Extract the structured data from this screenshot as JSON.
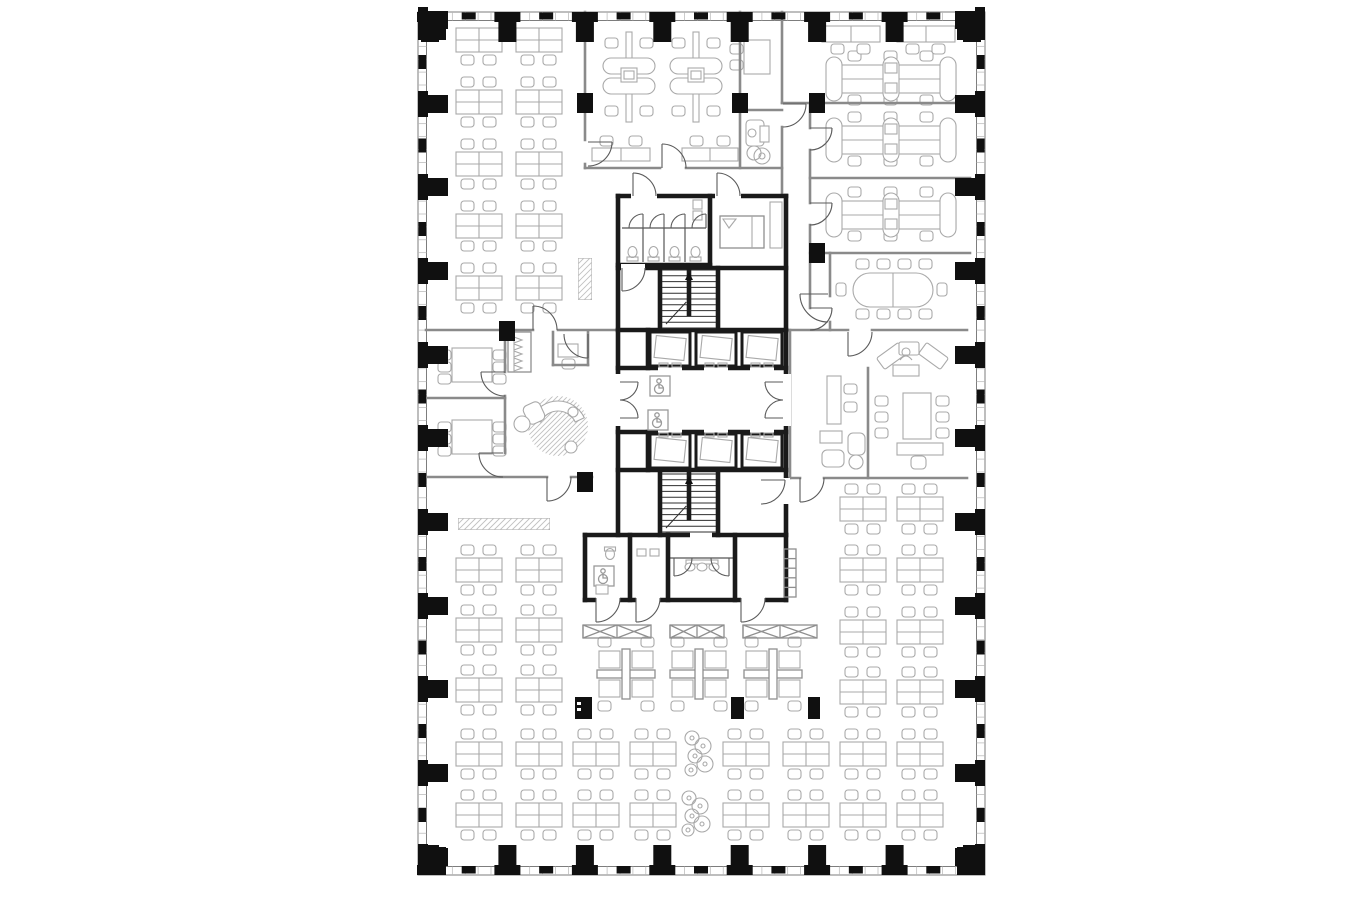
{
  "palette": {
    "background": "#ffffff",
    "wall_heavy": "#1a1a1a",
    "wall_partition": "#8a8a8a",
    "furniture": "#a9a9a9",
    "column": "#101010",
    "door": "#5a5a5a",
    "hatch": "#c0c0c0"
  },
  "plan": {
    "x": 418,
    "y": 12,
    "w": 567,
    "h": 863,
    "inner_x": 426.5,
    "inner_y": 20.5,
    "inner_r": 976.5,
    "inner_b": 866.5,
    "mullion_step": 12.9
  },
  "perimeter_columns": {
    "top_x": [
      430,
      507.4,
      584.9,
      662.3,
      739.7,
      817.1,
      894.6,
      972
    ],
    "bottom_x": [
      430,
      507.4,
      584.9,
      662.3,
      739.7,
      817.1,
      894.6,
      972
    ],
    "left_y": [
      20,
      104,
      187,
      271,
      355,
      438,
      522,
      606,
      689,
      773,
      857
    ],
    "right_y": [
      20,
      104,
      187,
      271,
      355,
      438,
      522,
      606,
      689,
      773,
      857
    ]
  },
  "interior_columns": [
    [
      585,
      103
    ],
    [
      740,
      103
    ],
    [
      817,
      103
    ],
    [
      817,
      253
    ],
    [
      507,
      331
    ],
    [
      585,
      482
    ]
  ],
  "risers": [
    [
      575,
      697,
      17,
      22,
      1
    ],
    [
      731,
      697,
      13,
      22,
      0
    ],
    [
      808,
      697,
      12,
      22,
      0
    ]
  ],
  "partition_walls": [
    [
      585,
      12,
      585,
      140
    ],
    [
      585,
      164,
      585,
      168
    ],
    [
      585,
      168,
      660,
      168
    ],
    [
      686,
      168,
      782,
      168
    ],
    [
      740,
      12,
      740,
      168
    ],
    [
      740,
      110,
      782,
      110
    ],
    [
      782,
      12,
      782,
      103
    ],
    [
      782,
      127,
      782,
      196
    ],
    [
      782,
      103,
      970,
      103
    ],
    [
      810,
      103,
      810,
      128
    ],
    [
      810,
      150,
      810,
      203
    ],
    [
      810,
      225,
      810,
      308
    ],
    [
      810,
      178,
      970,
      178
    ],
    [
      810,
      253,
      970,
      253
    ],
    [
      830,
      253,
      830,
      296
    ],
    [
      830,
      322,
      830,
      330
    ],
    [
      786,
      330,
      848,
      330
    ],
    [
      872,
      330,
      967,
      330
    ],
    [
      790,
      330,
      790,
      478
    ],
    [
      868,
      368,
      868,
      478
    ],
    [
      786,
      478,
      800,
      478
    ],
    [
      824,
      478,
      967,
      478
    ],
    [
      426,
      330,
      533,
      330
    ],
    [
      558,
      330,
      618,
      330
    ],
    [
      505,
      332,
      505,
      372
    ],
    [
      505,
      396,
      505,
      453
    ],
    [
      426,
      398,
      505,
      398
    ],
    [
      426,
      477,
      547,
      477
    ],
    [
      571,
      477,
      592,
      477
    ],
    [
      553,
      332,
      553,
      365
    ],
    [
      553,
      365,
      588,
      365
    ],
    [
      588,
      332,
      588,
      365
    ]
  ],
  "heavy_walls": [
    [
      618,
      196,
      786,
      196
    ],
    [
      618,
      196,
      618,
      535
    ],
    [
      786,
      196,
      786,
      535
    ],
    [
      618,
      265,
      710,
      265
    ],
    [
      710,
      196,
      710,
      265
    ],
    [
      618,
      268,
      786,
      268
    ],
    [
      660,
      268,
      660,
      330
    ],
    [
      718,
      268,
      718,
      330
    ],
    [
      618,
      330,
      786,
      330
    ],
    [
      618,
      368,
      786,
      368
    ],
    [
      648,
      330,
      648,
      368
    ],
    [
      618,
      432,
      786,
      432
    ],
    [
      648,
      432,
      648,
      470
    ],
    [
      618,
      470,
      786,
      470
    ],
    [
      660,
      470,
      660,
      535
    ],
    [
      718,
      470,
      718,
      535
    ],
    [
      585,
      535,
      786,
      535
    ],
    [
      585,
      535,
      585,
      600
    ],
    [
      585,
      600,
      786,
      600
    ],
    [
      786,
      535,
      786,
      600
    ],
    [
      630,
      535,
      630,
      600
    ],
    [
      668,
      535,
      668,
      600
    ],
    [
      735,
      535,
      735,
      600
    ]
  ],
  "thin_walls": [
    [
      622,
      228,
      706,
      228
    ],
    [
      668,
      558,
      735,
      558
    ]
  ],
  "wall_gaps": [
    [
      613,
      374,
      10,
      52
    ],
    [
      780,
      374,
      11,
      52
    ],
    [
      658,
      364,
      24,
      8
    ],
    [
      704,
      364,
      24,
      8
    ],
    [
      750,
      364,
      24,
      8
    ],
    [
      658,
      428,
      24,
      8
    ],
    [
      704,
      428,
      24,
      8
    ],
    [
      750,
      428,
      24,
      8
    ],
    [
      631,
      192,
      26,
      8
    ],
    [
      715,
      192,
      26,
      8
    ],
    [
      596,
      596,
      24,
      8
    ],
    [
      636,
      596,
      24,
      8
    ],
    [
      741,
      596,
      24,
      8
    ],
    [
      782,
      478,
      8,
      26
    ],
    [
      621,
      264,
      24,
      8
    ],
    [
      690,
      531,
      22,
      8
    ]
  ],
  "doors": [
    {
      "h": [
        588,
        142
      ],
      "l": [
        588,
        166
      ],
      "e": [
        612,
        142
      ]
    },
    {
      "h": [
        662,
        168
      ],
      "l": [
        686,
        168
      ],
      "e": [
        662,
        144
      ]
    },
    {
      "h": [
        783,
        104
      ],
      "l": [
        783,
        127
      ],
      "e": [
        806,
        104
      ]
    },
    {
      "h": [
        810,
        128
      ],
      "l": [
        810,
        150
      ],
      "e": [
        832,
        128
      ]
    },
    {
      "h": [
        810,
        203
      ],
      "l": [
        810,
        225
      ],
      "e": [
        832,
        203
      ]
    },
    {
      "h": [
        810,
        308
      ],
      "l": [
        810,
        330
      ],
      "e": [
        832,
        308
      ]
    },
    {
      "h": [
        828,
        294
      ],
      "l": [
        828,
        322
      ],
      "e": [
        800,
        294
      ]
    },
    {
      "h": [
        848,
        332
      ],
      "l": [
        872,
        332
      ],
      "e": [
        848,
        356
      ]
    },
    {
      "h": [
        633,
        196
      ],
      "l": [
        656,
        196
      ],
      "e": [
        633,
        173
      ]
    },
    {
      "h": [
        717,
        196
      ],
      "l": [
        740,
        196
      ],
      "e": [
        717,
        173
      ]
    },
    {
      "h": [
        533,
        330
      ],
      "l": [
        557,
        330
      ],
      "e": [
        533,
        306
      ]
    },
    {
      "h": [
        505,
        372
      ],
      "l": [
        505,
        396
      ],
      "e": [
        481,
        372
      ]
    },
    {
      "h": [
        503,
        453
      ],
      "l": [
        503,
        477
      ],
      "e": [
        479,
        453
      ]
    },
    {
      "h": [
        547,
        477
      ],
      "l": [
        571,
        477
      ],
      "e": [
        547,
        501
      ]
    },
    {
      "h": [
        588,
        334
      ],
      "l": [
        564,
        334
      ],
      "e": [
        588,
        358
      ]
    },
    {
      "h": [
        622,
        268
      ],
      "l": [
        645,
        268
      ],
      "e": [
        622,
        291
      ]
    },
    {
      "h": [
        620,
        382
      ],
      "l": [
        620,
        400
      ],
      "e": [
        638,
        382
      ]
    },
    {
      "h": [
        620,
        418
      ],
      "l": [
        620,
        400
      ],
      "e": [
        638,
        418
      ]
    },
    {
      "h": [
        783,
        382
      ],
      "l": [
        783,
        400
      ],
      "e": [
        765,
        382
      ]
    },
    {
      "h": [
        783,
        418
      ],
      "l": [
        783,
        400
      ],
      "e": [
        765,
        418
      ]
    },
    {
      "h": [
        761,
        480
      ],
      "l": [
        761,
        504
      ],
      "e": [
        785,
        480
      ]
    },
    {
      "h": [
        596,
        598
      ],
      "l": [
        620,
        598
      ],
      "e": [
        596,
        622
      ]
    },
    {
      "h": [
        636,
        598
      ],
      "l": [
        660,
        598
      ],
      "e": [
        636,
        622
      ]
    },
    {
      "h": [
        741,
        598
      ],
      "l": [
        765,
        598
      ],
      "e": [
        741,
        622
      ]
    },
    {
      "h": [
        674,
        558
      ],
      "l": [
        692,
        558
      ],
      "e": [
        674,
        576
      ]
    },
    {
      "h": [
        729,
        558
      ],
      "l": [
        711,
        558
      ],
      "e": [
        729,
        576
      ]
    },
    {
      "h": [
        800,
        478
      ],
      "l": [
        824,
        478
      ],
      "e": [
        800,
        502
      ]
    },
    {
      "h": [
        643,
        228
      ],
      "l": [
        629,
        228
      ],
      "e": [
        643,
        214
      ]
    },
    {
      "h": [
        664,
        228
      ],
      "l": [
        650,
        228
      ],
      "e": [
        664,
        214
      ]
    },
    {
      "h": [
        685,
        228
      ],
      "l": [
        671,
        228
      ],
      "e": [
        685,
        214
      ]
    },
    {
      "h": [
        706,
        228
      ],
      "l": [
        692,
        228
      ],
      "e": [
        706,
        214
      ]
    }
  ],
  "furniture": {
    "desk_cluster_groups": [
      {
        "cols": [
          456,
          516
        ],
        "rows": [
          28
        ],
        "chairs": "bottom"
      },
      {
        "cols": [
          456,
          516
        ],
        "rows": [
          90,
          152,
          214,
          276
        ],
        "chairs": "both"
      },
      {
        "cols": [
          456,
          516
        ],
        "rows": [
          558,
          618,
          678
        ],
        "chairs": "both"
      },
      {
        "cols": [
          456,
          516,
          573,
          630,
          723,
          783,
          840,
          897
        ],
        "rows": [
          742,
          803
        ],
        "chairs": "both"
      },
      {
        "cols": [
          840,
          897
        ],
        "rows": [
          497,
          558,
          620,
          680
        ],
        "chairs": "both"
      }
    ],
    "pinwheels": [
      [
        597,
        649
      ],
      [
        670,
        649
      ],
      [
        744,
        649
      ]
    ],
    "bench_rows": [
      [
        826,
        57
      ],
      [
        826,
        118
      ],
      [
        826,
        193
      ]
    ],
    "desk_pairs": [
      [
        822,
        26
      ],
      [
        897,
        26
      ]
    ],
    "pods": [
      [
        603,
        32
      ],
      [
        670,
        32
      ]
    ],
    "roomA_desks": [
      [
        592,
        148,
        58
      ],
      [
        682,
        148,
        56
      ]
    ],
    "roomB_desk": {
      "rect": [
        744,
        40,
        26,
        34
      ],
      "chairs": [
        [
          730,
          44
        ],
        [
          730,
          60
        ]
      ]
    },
    "copier": {
      "x": 746,
      "y": 120
    },
    "plant_small": [
      762,
      156
    ],
    "meeting_tables": [
      [
        452,
        348,
        40,
        34
      ],
      [
        452,
        420,
        40,
        34
      ]
    ],
    "closet": {
      "rect": [
        508,
        332,
        23,
        40
      ],
      "hangers": 5
    },
    "phone_desk": [
      558,
      344,
      20,
      13
    ],
    "conference": {
      "table": [
        853,
        273,
        80,
        34
      ],
      "top_x": [
        856,
        877,
        898,
        919
      ],
      "bot_x": [
        856,
        877,
        898,
        919
      ],
      "cy_top": 259,
      "cy_bot": 309,
      "side": [
        [
          836,
          283
        ],
        [
          937,
          283
        ]
      ]
    },
    "credenzas": [
      [
        583,
        625,
        68,
        13
      ],
      [
        670,
        625,
        54,
        13
      ],
      [
        743,
        625,
        74,
        13
      ]
    ],
    "hatch_strips": [
      [
        458,
        518,
        92,
        12
      ],
      [
        578,
        258,
        14,
        42
      ]
    ],
    "plants": [
      [
        700,
        753
      ],
      [
        697,
        813
      ]
    ],
    "lounge": {
      "rug": [
        558,
        426,
        30
      ],
      "sofa": {
        "c": [
          558,
          430
        ],
        "r1": 19,
        "r2": 29,
        "a0": -155,
        "a1": -25
      },
      "armchair": [
        525,
        403,
        18,
        20,
        -25
      ],
      "tables": [
        [
          522,
          424,
          8
        ],
        [
          571,
          447,
          6
        ]
      ],
      "lamp": [
        573,
        412,
        5
      ]
    },
    "exec": {
      "desk": [
        827,
        376,
        14,
        48
      ],
      "desk_chairs": [
        [
          844,
          384
        ],
        [
          844,
          402
        ]
      ],
      "table_small": [
        820,
        431,
        22,
        12
      ],
      "armchairs": [
        [
          822,
          450,
          22,
          17
        ],
        [
          848,
          433,
          17,
          22
        ]
      ],
      "round_table": [
        856,
        462,
        7
      ],
      "reception": {
        "left": [
          878,
          349,
          27,
          14,
          -36
        ],
        "right": [
          920,
          349,
          27,
          14,
          36
        ],
        "center": [
          899,
          342,
          20,
          13
        ],
        "person": [
          906,
          352
        ],
        "under": [
          893,
          365,
          26,
          11
        ]
      },
      "meeting_table": [
        903,
        393,
        28,
        46
      ],
      "chairs_left_x": 888,
      "chairs_right_x": 936,
      "chairs_y": [
        396,
        412,
        428
      ],
      "credenza": [
        897,
        443,
        46,
        12
      ],
      "office_chair": [
        911,
        456,
        15,
        13
      ]
    }
  },
  "core": {
    "stalls": {
      "x0": 622,
      "count": 4,
      "pitch": 21,
      "front_y": 228,
      "back_y": 262
    },
    "vestibule_sinks": [
      [
        693,
        200
      ],
      [
        693,
        211
      ]
    ],
    "bed": [
      720,
      216,
      44,
      32
    ],
    "counter": [
      770,
      202,
      12,
      46
    ],
    "stairs": [
      {
        "x": 662,
        "y": 270,
        "w": 54,
        "h": 58
      },
      {
        "x": 662,
        "y": 474,
        "w": 54,
        "h": 58
      }
    ],
    "elevators": {
      "xs": [
        650,
        696,
        742
      ],
      "w": 40,
      "h": 34,
      "rows": [
        {
          "y": 332,
          "open": "bottom"
        },
        {
          "y": 434,
          "open": "top"
        }
      ]
    },
    "wc_icons": [
      [
        650,
        376
      ],
      [
        648,
        410
      ]
    ],
    "acc_wc": {
      "icon": [
        594,
        566
      ],
      "toilet": [
        610,
        549
      ],
      "sink": [
        596,
        585
      ]
    },
    "urinals": [
      [
        637,
        549
      ],
      [
        650,
        549
      ]
    ],
    "sinks_mid": [
      [
        690,
        567
      ],
      [
        702,
        567
      ],
      [
        714,
        567
      ]
    ],
    "locker_panel": [
      784,
      549,
      12,
      48
    ]
  }
}
